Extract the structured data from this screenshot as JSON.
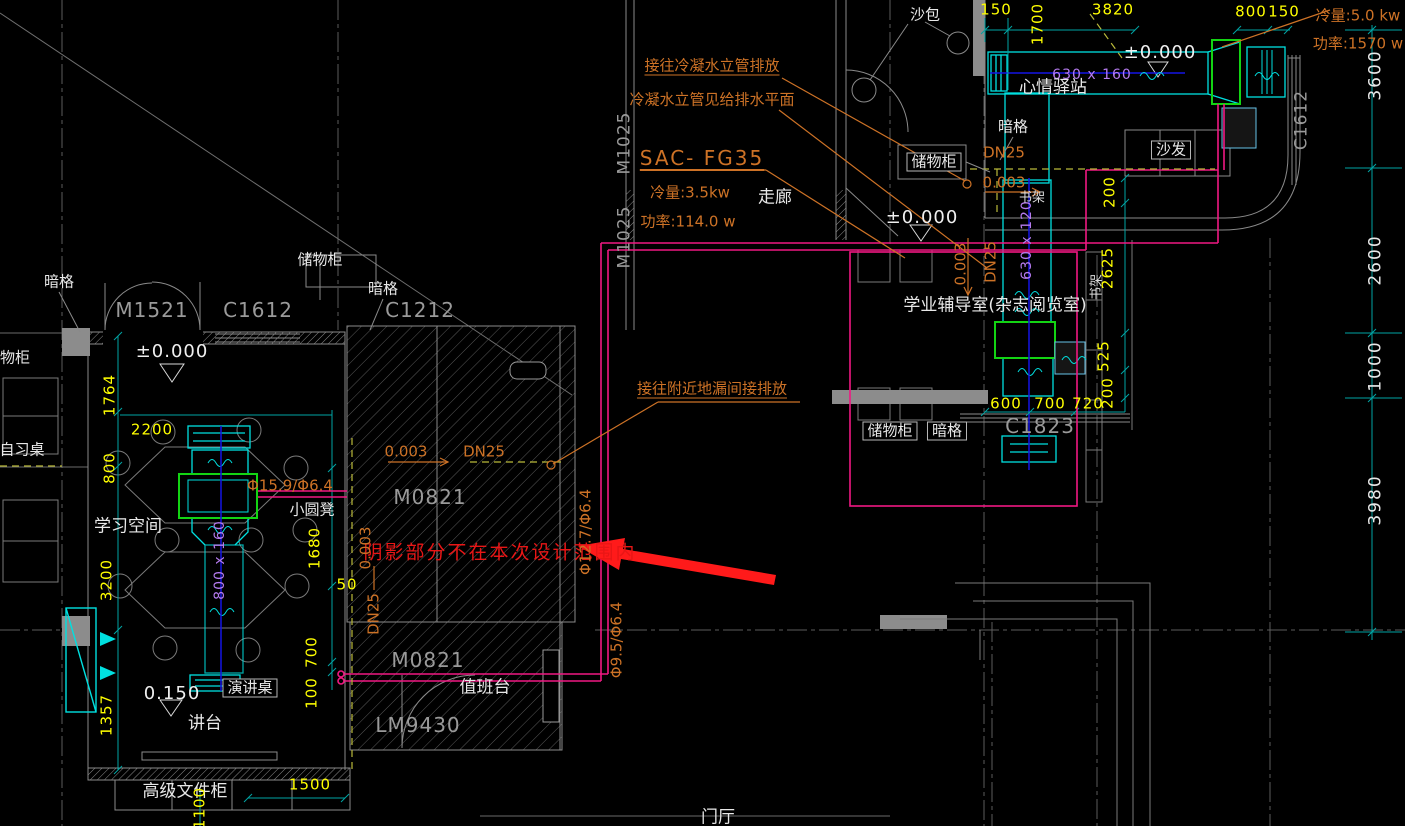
{
  "colors": {
    "background": "#000000",
    "linework_gray": "#7a7a7a",
    "dim_yellow": "#ffff00",
    "dim_teal": "#00a5a5",
    "annotation_orange": "#cd7226",
    "pipe_magenta": "#f01882",
    "duct_cyan": "#00e0e0",
    "fcu_green": "#13d413",
    "duct_size_purple": "#b57bee",
    "warning_red": "#e81616",
    "condensate_olive": "#b9b93a",
    "centerline_blue": "#1414e6"
  },
  "labels": {
    "an_ge": "暗格",
    "chuwugui": "储物柜",
    "wugui": "物柜",
    "zixizhuo": "自习桌",
    "xuexi_kongjian": "学习空间",
    "xiao_yuandeng": "小圆凳",
    "yanjiang_zhuo": "演讲桌",
    "jiangtai": "讲台",
    "gaoji_wenjiangui": "高级文件柜",
    "zhiban_tai": "值班台",
    "menting": "门厅",
    "zoulang": "走廊",
    "shabao": "沙包",
    "xinqing_yizhan": "心情驿站",
    "shafa": "沙发",
    "xueye_fudao": "学业辅导室(杂志阅览室)",
    "shujia": "书架"
  },
  "codes": {
    "m1521": "M1521",
    "c1612": "C1612",
    "c1212": "C1212",
    "m0821": "M0821",
    "lm9430": "LM9430",
    "m1025": "M1025",
    "c1823": "C1823"
  },
  "levels": {
    "zero": "±0.000",
    "l150": "0.150",
    "slope": "0.003"
  },
  "pipes": {
    "dn25": "DN25",
    "phi159": "Φ15.9/Φ6.4",
    "phi127": "Φ12.7/Φ6.4",
    "phi95": "Φ9.5/Φ6.4"
  },
  "hvac": {
    "unit": "SAC- FG35",
    "cooling_35": "冷量:3.5kw",
    "power_114": "功率:114.0 w",
    "cooling_50": "冷量:5.0 kw",
    "power_1570": "功率:1570 w",
    "duct_800x160": "800 x 160",
    "duct_630x160": "630 x 160",
    "duct_630x120": "630 x 120"
  },
  "notes": {
    "drain_riser": "接往冷凝水立管排放",
    "riser_ref": "冷凝水立管见给排水平面",
    "floor_drain": "接往附近地漏间接排放",
    "out_of_scope": "阴影部分不在本次设计范围内"
  },
  "dims": {
    "d50": "50",
    "d100": "100",
    "d150": "150",
    "d200": "200",
    "d525": "525",
    "d600": "600",
    "d700": "700",
    "d720": "720",
    "d800": "800",
    "d1000": "1000",
    "d1100": "1100",
    "d1357": "1357",
    "d1500": "1500",
    "d1680": "1680",
    "d1700": "1700",
    "d1764": "1764",
    "d2200": "2200",
    "d2600": "2600",
    "d2625": "2625",
    "d3200": "3200",
    "d3600": "3600",
    "d3820": "3820",
    "d3980": "3980"
  }
}
